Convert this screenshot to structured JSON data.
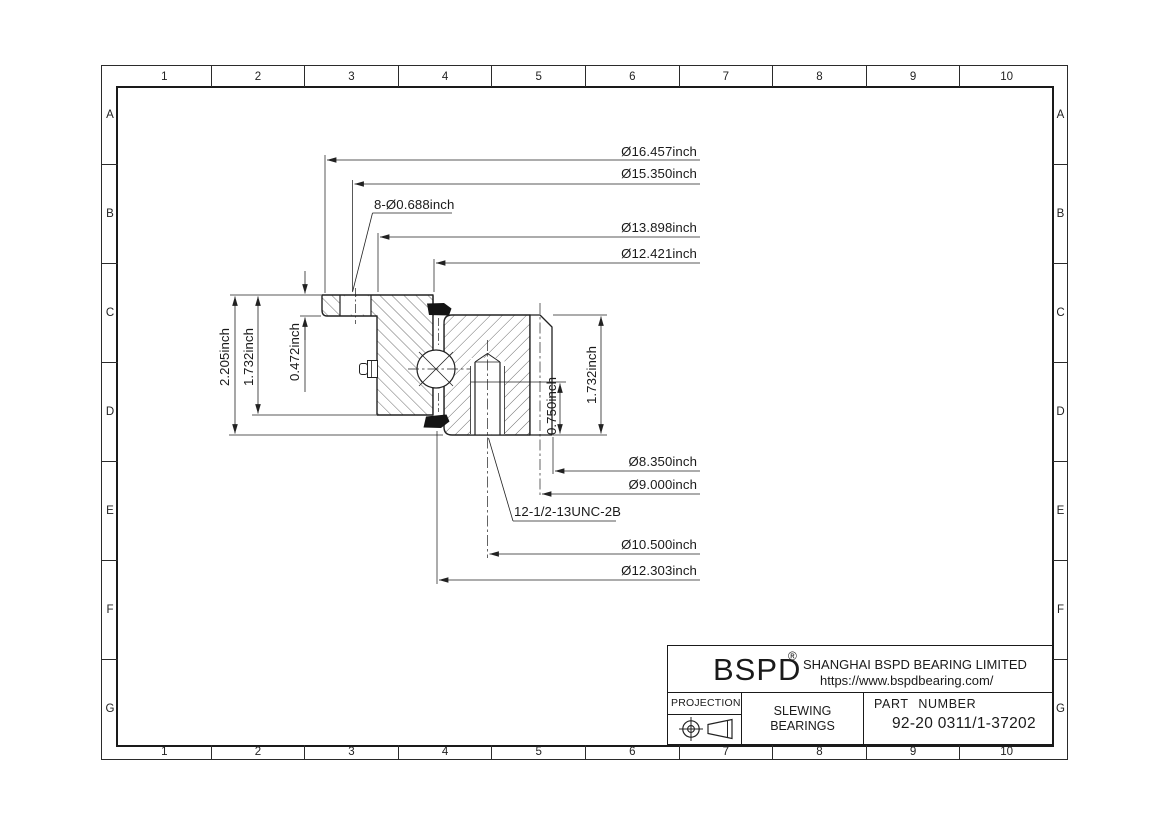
{
  "sheet": {
    "grid_columns": [
      "1",
      "2",
      "3",
      "4",
      "5",
      "6",
      "7",
      "8",
      "9",
      "10"
    ],
    "grid_rows": [
      "A",
      "B",
      "C",
      "D",
      "E",
      "F",
      "G"
    ]
  },
  "drawing": {
    "dims": {
      "outer_diameter": "Ø16.457inch",
      "flange_bolt_circle": "Ø15.350inch",
      "flange_holes": "8-Ø0.688inch",
      "flange_inner_diameter": "Ø13.898inch",
      "raceway_diameter_upper": "Ø12.421inch",
      "overall_height": "2.205inch",
      "outer_ring_height": "1.732inch",
      "flange_thickness": "0.472inch",
      "bore_diameter": "Ø8.350inch",
      "inner_step_diameter": "Ø9.000inch",
      "tapped_holes": "12-1/2-13UNC-2B",
      "tapped_bolt_circle": "Ø10.500inch",
      "raceway_diameter_lower": "Ø12.303inch",
      "thread_depth": "0.750inch",
      "inner_ring_height": "1.732inch"
    }
  },
  "title_block": {
    "logo": "BSPD",
    "registered_mark": "®",
    "company_name": "SHANGHAI BSPD BEARING LIMITED",
    "website": "https://www.bspdbearing.com/",
    "projection_label": "PROJECTION",
    "product_line1": "SLEWING",
    "product_line2": "BEARINGS",
    "part_number_label": "PART NUMBER",
    "part_number": "92-20 0311/1-37202"
  }
}
